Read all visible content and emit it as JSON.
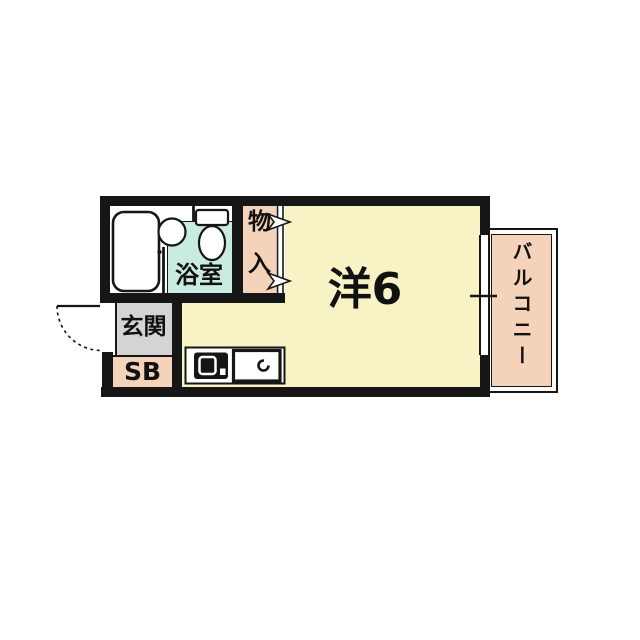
{
  "floorplan": {
    "kind": "japanese-apartment-floor-plan",
    "rooms": {
      "main_room": {
        "label": "洋6",
        "fill": "#F8F3C4"
      },
      "bathroom": {
        "label": "浴室",
        "fill": "#C8EBE2"
      },
      "closet": {
        "label": "物入",
        "char_top": "物",
        "char_bottom": "入",
        "fill": "#F5D3BA"
      },
      "entrance": {
        "label": "玄関",
        "fill": "#D5D3D4"
      },
      "shoe_box": {
        "label": "SB",
        "fill": "#F5D3BA"
      },
      "balcony": {
        "label": "バルコニー",
        "fill": "#F5D3BA"
      }
    },
    "fixtures": {
      "bathtub": "bathtub-icon",
      "washbasin": "washbasin-icon",
      "toilet": "toilet-icon",
      "stove": "stove-icon",
      "kitchen_sink": "kitchen-sink-icon",
      "entrance_door": "door-swing-arc",
      "closet_doors": "right-arrow-markers",
      "window": "sliding-window-with-center-tick"
    },
    "colors": {
      "wall": "#161616",
      "background": "#FFFFFF",
      "room_yellow": "#F8F3C4",
      "peach": "#F5D3BA",
      "gray": "#D5D3D4",
      "cyan": "#C8EBE2"
    }
  }
}
